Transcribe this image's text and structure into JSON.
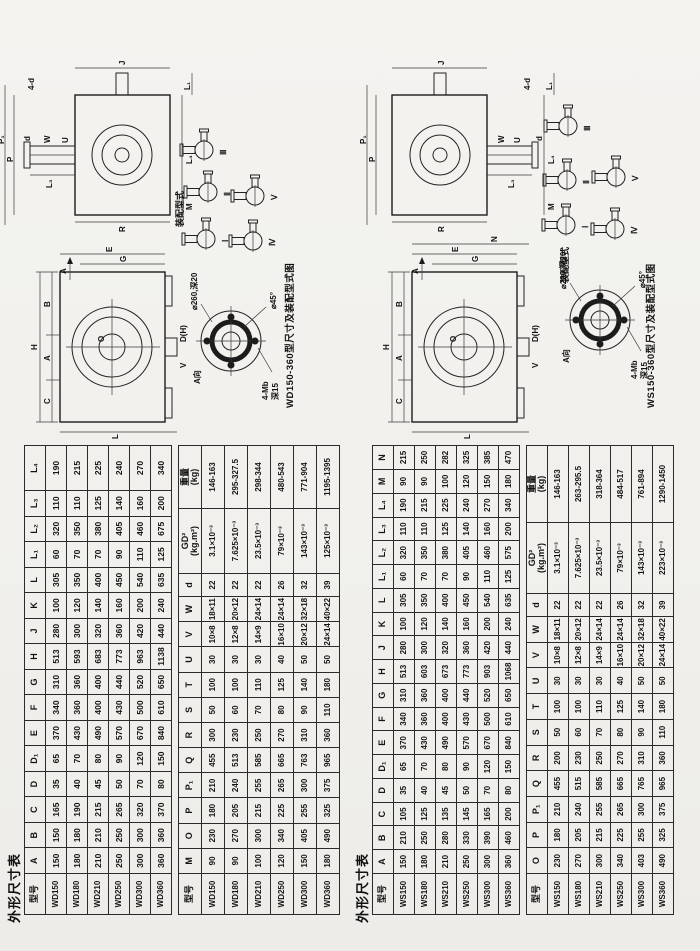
{
  "wd": {
    "title": "外形尺寸表",
    "table1": {
      "headers": [
        "型号",
        "A",
        "B",
        "C",
        "D",
        "D₁",
        "E",
        "F",
        "G",
        "H",
        "J",
        "K",
        "L",
        "L₁",
        "L₂",
        "L₃",
        "L₄"
      ],
      "rows": [
        [
          "WD150",
          150,
          150,
          165,
          35,
          65,
          370,
          340,
          310,
          513,
          280,
          100,
          305,
          60,
          320,
          110,
          190
        ],
        [
          "WD180",
          180,
          180,
          190,
          40,
          70,
          430,
          360,
          360,
          593,
          300,
          120,
          350,
          70,
          350,
          110,
          215
        ],
        [
          "WD210",
          210,
          210,
          215,
          45,
          80,
          490,
          400,
          400,
          683,
          320,
          140,
          400,
          70,
          380,
          125,
          225
        ],
        [
          "WD250",
          250,
          250,
          265,
          50,
          90,
          570,
          430,
          440,
          773,
          360,
          160,
          450,
          90,
          405,
          140,
          240
        ],
        [
          "WD300",
          300,
          300,
          320,
          70,
          120,
          670,
          500,
          520,
          963,
          420,
          200,
          540,
          110,
          460,
          160,
          270
        ],
        [
          "WD360",
          360,
          360,
          370,
          80,
          150,
          840,
          610,
          650,
          1138,
          440,
          240,
          635,
          125,
          675,
          200,
          340
        ]
      ]
    },
    "table2": {
      "headers": [
        "型号",
        "M",
        "O",
        "P",
        "P₁",
        "Q",
        "R",
        "S",
        "T",
        "U",
        "V",
        "W",
        "d",
        "GD²\n(kg.m²)",
        "重量\n(kg)"
      ],
      "rows": [
        [
          "WD150",
          90,
          230,
          180,
          210,
          455,
          300,
          50,
          100,
          30,
          "10×8",
          "18×11",
          22,
          "3.1×10⁻³",
          "146-163"
        ],
        [
          "WD180",
          90,
          270,
          205,
          240,
          513,
          230,
          60,
          100,
          30,
          "12×8",
          "20×12",
          22,
          "7.625×10⁻³",
          "295-327.5"
        ],
        [
          "WD210",
          100,
          300,
          215,
          255,
          585,
          250,
          70,
          110,
          30,
          "14×9",
          "24×14",
          22,
          "23.5×10⁻³",
          "298-344"
        ],
        [
          "WD250",
          120,
          340,
          225,
          265,
          665,
          270,
          80,
          125,
          40,
          "16×10",
          "24×14",
          26,
          "79×10⁻³",
          "480-543"
        ],
        [
          "WD300",
          150,
          405,
          255,
          300,
          763,
          310,
          90,
          140,
          50,
          "20×12",
          "32×18",
          32,
          "143×10⁻³",
          "771-904"
        ],
        [
          "WD360",
          180,
          490,
          325,
          375,
          965,
          360,
          110,
          180,
          50,
          "24×14",
          "40×22",
          39,
          "125×10⁻³",
          "1195-1395"
        ]
      ]
    },
    "drawing": {
      "caption": "WD150-360型尺寸及装配型式图",
      "assembly_label": "装配型式",
      "assembly": {
        "i": "Ⅰ",
        "ii": "Ⅱ",
        "iii": "Ⅲ",
        "iv": "Ⅳ",
        "v": "Ⅴ"
      },
      "front": {
        "h": "H",
        "c": "C",
        "a": "A",
        "b": "B",
        "l": "L",
        "o": "O",
        "g": "G",
        "e": "E",
        "v": "V",
        "dh": "D(H)",
        "arrow": "A"
      },
      "side": {
        "l3": "L₃",
        "p1": "P₁",
        "p": "P",
        "r": "R",
        "j": "J",
        "w": "W",
        "u": "U",
        "d": "d",
        "l4": "L₄",
        "l1": "L₁",
        "m": "M",
        "note": "4-d"
      },
      "flange": {
        "title": "A向",
        "bolts": "4-Mb",
        "depth": "深15",
        "bore": "⌀260,深20",
        "chamfer": "⌀45°"
      }
    }
  },
  "ws": {
    "title": "外形尺寸表",
    "table1": {
      "headers": [
        "型号",
        "A",
        "B",
        "C",
        "D",
        "D₁",
        "E",
        "F",
        "G",
        "H",
        "J",
        "K",
        "L",
        "L₁",
        "L₂",
        "L₃",
        "L₄",
        "M",
        "N"
      ],
      "rows": [
        [
          "WS150",
          150,
          210,
          105,
          35,
          65,
          370,
          340,
          310,
          513,
          280,
          100,
          305,
          60,
          320,
          110,
          190,
          90,
          215
        ],
        [
          "WS180",
          180,
          250,
          125,
          40,
          70,
          430,
          360,
          360,
          603,
          300,
          120,
          350,
          70,
          350,
          110,
          215,
          90,
          250
        ],
        [
          "WS210",
          210,
          280,
          135,
          45,
          80,
          490,
          400,
          400,
          673,
          320,
          140,
          400,
          70,
          380,
          125,
          225,
          100,
          282
        ],
        [
          "WS250",
          250,
          330,
          145,
          50,
          90,
          570,
          430,
          440,
          773,
          360,
          160,
          450,
          90,
          405,
          140,
          240,
          120,
          325
        ],
        [
          "WS300",
          300,
          390,
          165,
          70,
          120,
          670,
          500,
          520,
          903,
          420,
          200,
          540,
          110,
          460,
          160,
          270,
          150,
          385
        ],
        [
          "WS360",
          360,
          460,
          200,
          80,
          150,
          840,
          610,
          650,
          1068,
          440,
          240,
          635,
          125,
          575,
          200,
          340,
          180,
          470
        ]
      ]
    },
    "table2": {
      "headers": [
        "型号",
        "O",
        "P",
        "P₁",
        "Q",
        "R",
        "S",
        "T",
        "U",
        "V",
        "W",
        "d",
        "GD²\n(kg.m²)",
        "重量\n(kg)"
      ],
      "rows": [
        [
          "WS150",
          230,
          180,
          210,
          455,
          200,
          50,
          100,
          30,
          "10×8",
          "18×11",
          22,
          "3.1×10⁻³",
          "146-163"
        ],
        [
          "WS180",
          270,
          205,
          240,
          515,
          230,
          60,
          100,
          30,
          "12×8",
          "20×12",
          22,
          "7.625×10⁻³",
          "263-295.5"
        ],
        [
          "WS210",
          300,
          215,
          255,
          585,
          250,
          70,
          110,
          30,
          "14×9",
          "24×14",
          22,
          "23.5×10⁻³",
          "318-364"
        ],
        [
          "WS250",
          340,
          225,
          265,
          665,
          270,
          80,
          125,
          40,
          "16×10",
          "24×14",
          26,
          "79×10⁻³",
          "484-517"
        ],
        [
          "WS300",
          403,
          255,
          300,
          765,
          310,
          90,
          140,
          50,
          "20×12",
          "32×18",
          32,
          "143×10⁻³",
          "761-894"
        ],
        [
          "WS360",
          490,
          325,
          375,
          965,
          360,
          110,
          180,
          50,
          "24×14",
          "40×22",
          39,
          "223×10⁻³",
          "1290-1450"
        ]
      ]
    },
    "drawing": {
      "caption": "WS150-360型尺寸及装配型式图",
      "assembly_label": "装配型式",
      "assembly": {
        "i": "Ⅰ",
        "ii": "Ⅱ",
        "iii": "Ⅲ",
        "iv": "Ⅳ",
        "v": "Ⅴ"
      },
      "front": {
        "h": "H",
        "c": "C",
        "a": "A",
        "b": "B",
        "l": "L",
        "o": "O",
        "g": "G",
        "e": "E",
        "n": "N",
        "v": "V",
        "dh": "D(H)",
        "arrow": "A"
      },
      "side": {
        "l3": "L₃",
        "p1": "P₁",
        "p": "P",
        "r": "R",
        "j": "J",
        "w": "W",
        "u": "U",
        "d": "d",
        "l4": "L₄",
        "l1": "L₁",
        "m": "M",
        "note": "4-d"
      },
      "flange": {
        "title": "A向",
        "bolts": "4-Mb",
        "depth": "深15",
        "bore": "⌀200,深20",
        "chamfer": "⌀45°"
      }
    }
  }
}
